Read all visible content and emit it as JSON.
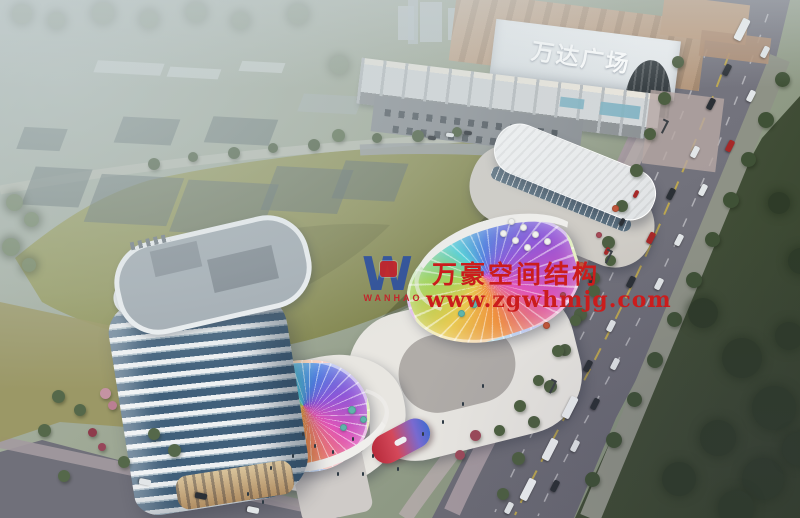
{
  "signs": {
    "mall": "万达广场"
  },
  "watermark": {
    "monogram": "W",
    "brand": "WANHAO",
    "title": "万豪空间结构",
    "url": "www.zgwhmjg.com",
    "red": "#cb1c1c",
    "blue": "#2b4fa3"
  },
  "palette": {
    "haze": "#b7c2c4",
    "field_green": "#8e9157",
    "lawn_dark": "#3e4a34",
    "road_gray": "#73737d",
    "tower_glass": "#41607b",
    "tower_white": "#eef1f3",
    "mall_roof_tan": "#c2a68d",
    "canopy_rainbow": [
      "#e8c94f",
      "#9fd455",
      "#4ecfd8",
      "#4f7de0",
      "#8e55d8",
      "#e055b8",
      "#f0913f"
    ]
  }
}
